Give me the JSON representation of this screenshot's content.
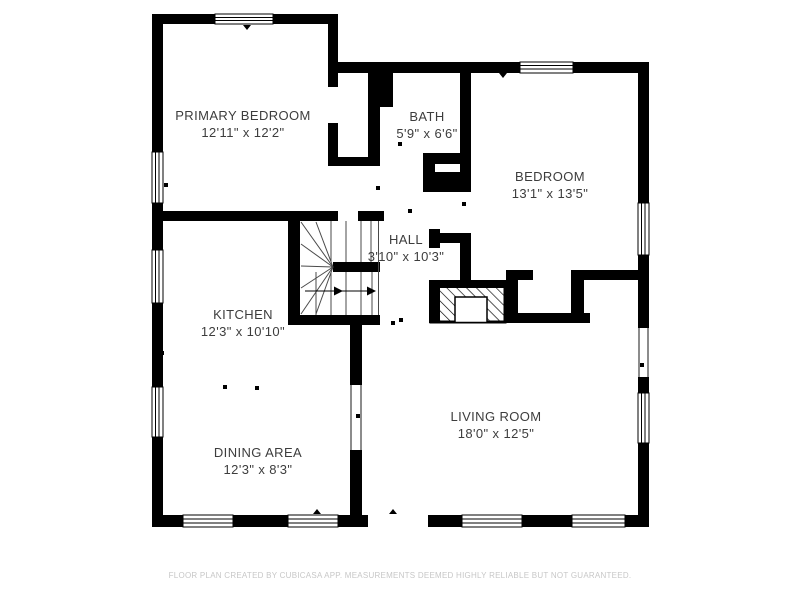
{
  "rooms": [
    {
      "id": "primary-bedroom",
      "name": "PRIMARY BEDROOM",
      "dims": "12'11\" x 12'2\""
    },
    {
      "id": "bath",
      "name": "BATH",
      "dims": "5'9\" x 6'6\""
    },
    {
      "id": "bedroom",
      "name": "BEDROOM",
      "dims": "13'1\" x 13'5\""
    },
    {
      "id": "hall",
      "name": "HALL",
      "dims": "3'10\" x 10'3\""
    },
    {
      "id": "kitchen",
      "name": "KITCHEN",
      "dims": "12'3\" x 10'10\""
    },
    {
      "id": "dining-area",
      "name": "DINING AREA",
      "dims": "12'3\" x 8'3\""
    },
    {
      "id": "living-room",
      "name": "LIVING ROOM",
      "dims": "18'0\" x 12'5\""
    }
  ],
  "footer": "FLOOR PLAN CREATED BY CUBICASA APP. MEASUREMENTS DEEMED HIGHLY RELIABLE BUT NOT GUARANTEED.",
  "colors": {
    "wall": "#000000",
    "label_text": "#3d3d3d",
    "footer_text": "#c7c7c7"
  }
}
